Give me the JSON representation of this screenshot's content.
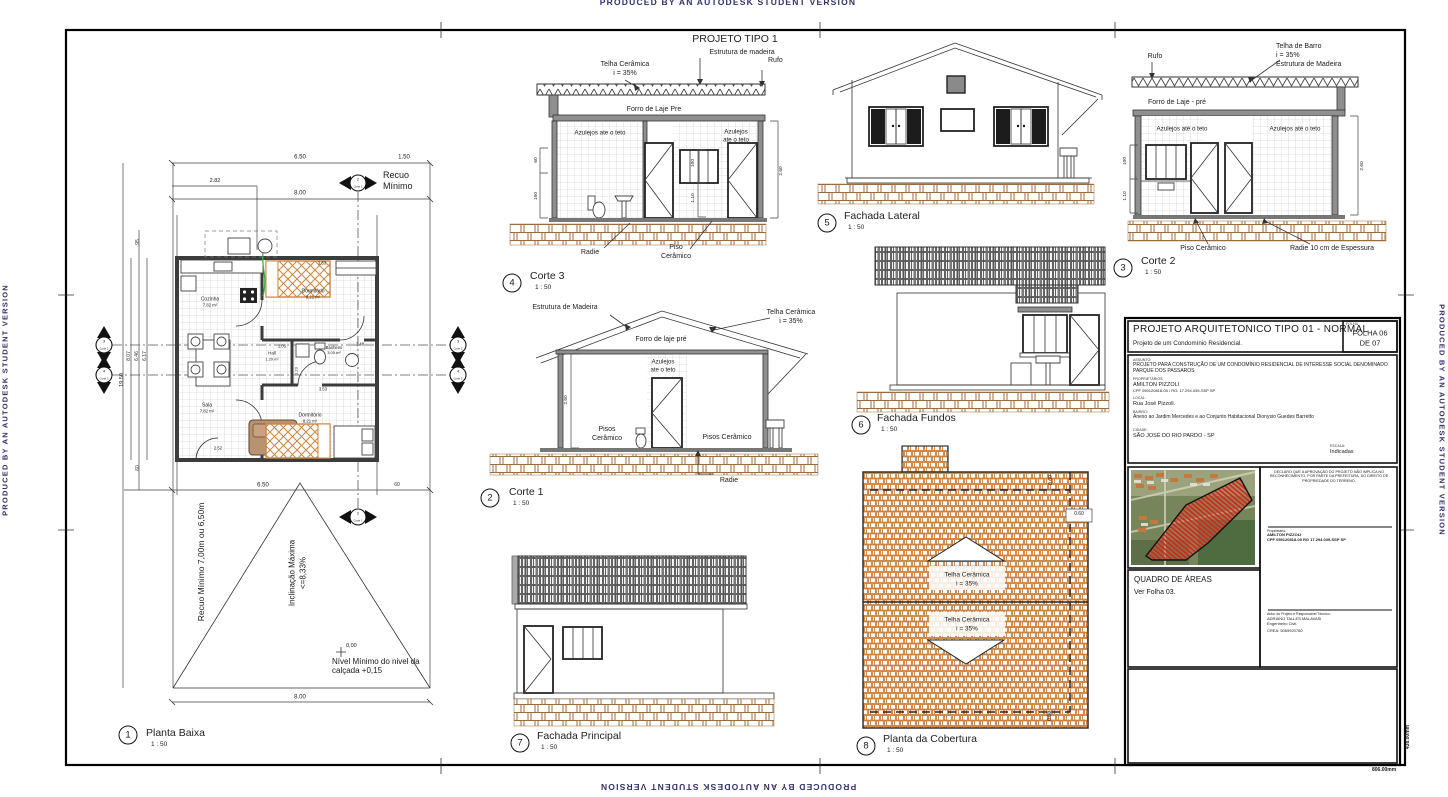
{
  "sheet": {
    "watermark": "PRODUCED BY AN AUTODESK STUDENT VERSION",
    "heading": "PROJETO TIPO 1",
    "frame_width_dim": "806.00mm",
    "frame_height_dim": "438.00mm"
  },
  "planta": {
    "num": "1",
    "title": "Planta Baixa",
    "scale": "1 : 50",
    "rooms": {
      "cozinha": {
        "name": "Cozinha",
        "area": "7.82 m²"
      },
      "dorm1": {
        "name": "Dormitório",
        "area": "8.21 m²"
      },
      "hall": {
        "name": "Hall",
        "area": "1.29 m²"
      },
      "banheiro": {
        "name": "Banheiro",
        "area": "3.05 m²"
      },
      "sala": {
        "name": "Sala",
        "area": "7.82 m²"
      },
      "dorm2": {
        "name": "Dormitório",
        "area": "8.21 m²"
      }
    },
    "dims": {
      "top1": "6.50",
      "top2": "1.50",
      "top3": "2.82",
      "top4": "8.00",
      "left95": "95",
      "left1950": "19.50",
      "left807": "8.07",
      "left646": "6.46",
      "left617": "6.17",
      "left60": "60",
      "bot650": "6.50",
      "bot60": "60",
      "bot800": "8.00",
      "i353a": "3.53",
      "i105": "1.05",
      "i248": "2.48",
      "i353b": "3.53",
      "i252": "2.52",
      "i123": "1.23"
    },
    "recuo_box1": "Recuo",
    "recuo_box2": "Mínimo",
    "recuo_lateral": "Recuo Mínimo 7,00m ou 6,50m",
    "incl1": "Inclinação Máxima",
    "incl2": "<=8,33%",
    "nivel": "Nível Mínimo do nivel da calçada +0,15",
    "zero": "0,00",
    "mk_c1_num": "2",
    "mk_c1": "Corte 1",
    "mk_c2_num": "3",
    "mk_c2": "Corte 2",
    "mk_c3_num": "4",
    "mk_c3": "Corte 3"
  },
  "corte3": {
    "num": "4",
    "title": "Corte 3",
    "scale": "1 : 50",
    "telha": "Telha Cerâmica",
    "telha_i": "i = 35%",
    "estrutura": "Estrutura de madeira",
    "rufo": "Rufo",
    "forro": "Forro de Laje Pre",
    "azulejos": "Azulejos ate o teto",
    "azulejos_r1": "Azulejos",
    "azulejos_r2": "ate o teto",
    "radie": "Radie",
    "piso1": "Piso",
    "piso2": "Cerâmico",
    "d60": "60",
    "d150": "150",
    "d100": "100",
    "d110": "1.10",
    "d260": "2.60"
  },
  "corte1": {
    "num": "2",
    "title": "Corte 1",
    "scale": "1 : 50",
    "estrutura": "Estrutura de Madeira",
    "telha": "Telha Cerâmica",
    "telha_i": "i = 35%",
    "forro": "Forro de laje pré",
    "azulejos1": "Azulejos",
    "azulejos2": "ate o teto",
    "pisos1": "Pisos",
    "pisos2": "Cerâmico",
    "pisos_r": "Pisos Cerâmico",
    "radie": "Radie",
    "d260": "2.60"
  },
  "corte2": {
    "num": "3",
    "title": "Corte 2",
    "scale": "1 : 50",
    "rufo": "Rufo",
    "telha": "Telha de Barro",
    "telha_i": "i = 35%",
    "estrutura": "Estrutura de Madeira",
    "forro": "Forro de Laje - pré",
    "azulejos_l": "Azulejos até o teto",
    "azulejos_r": "Azulejos até o teto",
    "piso": "Piso Cerâmico",
    "radie": "Radie 10 cm de Espessura",
    "d100": "100",
    "d110": "1.10",
    "d260": "2.60"
  },
  "lateral": {
    "num": "5",
    "title": "Fachada Lateral",
    "scale": "1 : 50"
  },
  "fundos": {
    "num": "6",
    "title": "Fachada Fundos",
    "scale": "1 : 50"
  },
  "principal": {
    "num": "7",
    "title": "Fachada Principal",
    "scale": "1 : 50"
  },
  "cobertura": {
    "num": "8",
    "title": "Planta da Cobertura",
    "scale": "1 : 50",
    "telha1a": "Telha Cerâmica",
    "telha1b": "i = 35%",
    "telha2a": "Telha Cerâmica",
    "telha2b": "i = 35%",
    "d060a": "0.60",
    "d060b": "0.60",
    "d060c": "0.60"
  },
  "titleblock": {
    "title": "PROJETO ARQUITETONICO TIPO 01 - NORMAL",
    "subtitle": "Projeto de um Condomínio Residencial.",
    "folha_cap": "FOLHA",
    "folha1": "FOLHA 06",
    "folha2": "DE 07",
    "assunto_cap": "ASSUNTO:",
    "assunto": "PROJETO PARA CONSTRUÇÃO DE UM CONDOMÍNIO RESIDENCIAL DE INTERESSE SOCIAL DENOMINADO  PARQUE DOS PASSAROS",
    "prop_cap": "PROPRIETÁRIOS:",
    "prop_nome": "AMILTON PIZZOLI",
    "prop_doc": "CPF 059120818-00 / RG: 17.294.039-SSP SP",
    "local_cap": "LOCAL:",
    "local": "Rua José Pizzoli.",
    "bairro_cap": "BAIRRO:",
    "bairro": "Anexo ao Jardim Mercedes e ao Conjunto Habitacional Dionysio Guedes Barretto",
    "cidade_cap": "CIDADE:",
    "cidade": "SÃO JOSÉ DO RIO PARDO - SP",
    "escala_cap": "ESCALA:",
    "escala": "Indicadas",
    "quadro": "QUADRO DE ÁREAS",
    "quadro_sub": "Ver Folha 03.",
    "declaracao": "DECLARO QUE A APROVAÇÃO DO PROJETO NÃO IMPLICA NO RECONHECIMENTO, POR PARTE DA PREFEITURA, DO DIREITO DE PROPRIEDADE DO TERRENO.",
    "sig1_cap": "Proprietário:",
    "sig1_nome": "AMILTON PIZZOLI",
    "sig1_doc": "CPF 059120818-00 RG 17.294.039-SSP SP",
    "sig2_cap": "Autor do Projeto e Responsável Técnico:",
    "sig2_nome": "ADRIANO TALLES MALAVASI",
    "sig2_role": "Engenheiro Civil.",
    "sig2_crea": "CREA: 5069920760"
  }
}
